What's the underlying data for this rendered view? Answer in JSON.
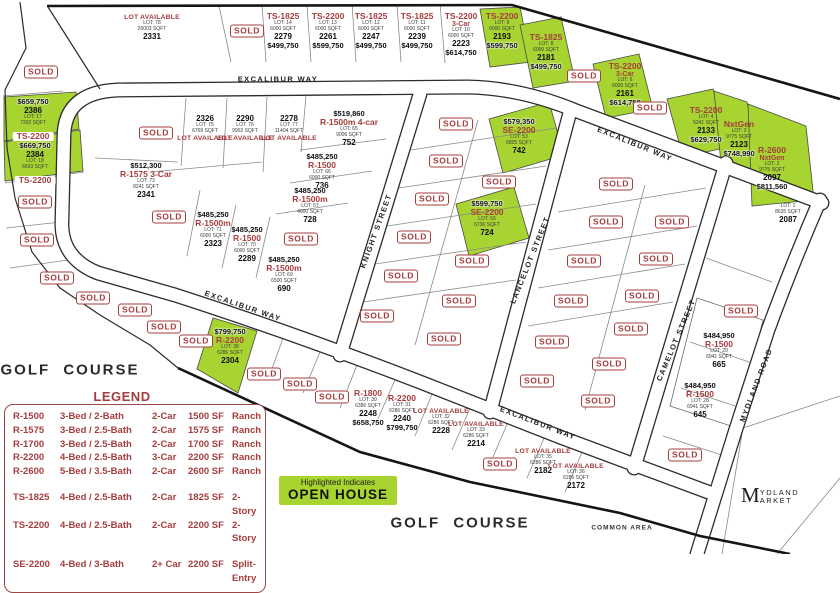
{
  "colors": {
    "accent_red": "#a63d3d",
    "highlight_green": "#a7d430",
    "gold": "#a8863c"
  },
  "header": {
    "development_line1": "HIDDEN BRIDGE",
    "development_line2": "RANCH",
    "builder": "EXCALIBUR",
    "builder_sub": "HOMES",
    "phone": "752-1259",
    "sales_address": "2097 Excalibur Way"
  },
  "sold": {
    "label": "SOLD"
  },
  "open_house": {
    "line1": "Highlighted Indicates",
    "line2": "OPEN HOUSE"
  },
  "market": {
    "initial": "M",
    "line1": "YDLAND",
    "line2": "ARKET"
  },
  "legend": {
    "title": "LEGEND",
    "rows": [
      {
        "model": "R-1500",
        "beds": "3-Bed / 2-Bath",
        "car": "2-Car",
        "sqft": "1500 SF",
        "style": "Ranch"
      },
      {
        "model": "R-1575",
        "beds": "3-Bed / 2.5-Bath",
        "car": "2-Car",
        "sqft": "1575 SF",
        "style": "Ranch"
      },
      {
        "model": "R-1700",
        "beds": "3-Bed / 2.5-Bath",
        "car": "2-Car",
        "sqft": "1700 SF",
        "style": "Ranch"
      },
      {
        "model": "R-2200",
        "beds": "4-Bed / 2.5-Bath",
        "car": "3-Car",
        "sqft": "2200 SF",
        "style": "Ranch"
      },
      {
        "model": "R-2600",
        "beds": "5-Bed / 3.5-Bath",
        "car": "2-Car",
        "sqft": "2600 SF",
        "style": "Ranch"
      },
      {
        "model": "TS-1825",
        "beds": "4-Bed / 2.5-Bath",
        "car": "2-Car",
        "sqft": "1825 SF",
        "style": "2-Story",
        "cls": "gap"
      },
      {
        "model": "TS-2200",
        "beds": "4-Bed / 2.5-Bath",
        "car": "2-Car",
        "sqft": "2200 SF",
        "style": "2-Story"
      },
      {
        "model": "SE-2200",
        "beds": "4-Bed / 3-Bath",
        "car": "2+ Car",
        "sqft": "2200 SF",
        "style": "Split-Entry",
        "cls": "gap"
      }
    ]
  },
  "streets": [
    {
      "text": "EXCALIBUR WAY",
      "x": 278,
      "y": 79,
      "rot": 0
    },
    {
      "text": "EXCALIBUR WAY",
      "x": 635,
      "y": 144,
      "rot": 22
    },
    {
      "text": "EXCALIBUR WAY",
      "x": 243,
      "y": 306,
      "rot": 19
    },
    {
      "text": "EXCALIBUR WAY",
      "x": 538,
      "y": 423,
      "rot": 21
    },
    {
      "text": "KNIGHT STREET",
      "x": 376,
      "y": 231,
      "rot": -70
    },
    {
      "text": "LANCELOT STREET",
      "x": 530,
      "y": 260,
      "rot": -68
    },
    {
      "text": "CAMELOT STREET",
      "x": 676,
      "y": 340,
      "rot": -67
    },
    {
      "text": "MYDLAND ROAD",
      "x": 756,
      "y": 385,
      "rot": -69
    }
  ],
  "area_labels": [
    {
      "text": "GOLF COURSE",
      "x": 70,
      "y": 370,
      "cls": "golf"
    },
    {
      "text": "GOLF COURSE",
      "x": 460,
      "y": 523,
      "cls": "golf"
    },
    {
      "text": "COMMON AREA",
      "x": 622,
      "y": 528,
      "cls": "tiny-label"
    }
  ],
  "sold_badges": [
    {
      "x": 247,
      "y": 31
    },
    {
      "x": 41,
      "y": 72
    },
    {
      "x": 584,
      "y": 76
    },
    {
      "x": 650,
      "y": 108
    },
    {
      "x": 35,
      "y": 202
    },
    {
      "x": 37,
      "y": 240
    },
    {
      "x": 57,
      "y": 278
    },
    {
      "x": 93,
      "y": 298
    },
    {
      "x": 156,
      "y": 133
    },
    {
      "x": 169,
      "y": 217
    },
    {
      "x": 301,
      "y": 239
    },
    {
      "x": 135,
      "y": 310
    },
    {
      "x": 164,
      "y": 327
    },
    {
      "x": 196,
      "y": 341
    },
    {
      "x": 264,
      "y": 374
    },
    {
      "x": 300,
      "y": 384
    },
    {
      "x": 332,
      "y": 397
    },
    {
      "x": 456,
      "y": 124
    },
    {
      "x": 446,
      "y": 161
    },
    {
      "x": 432,
      "y": 199
    },
    {
      "x": 414,
      "y": 237
    },
    {
      "x": 401,
      "y": 276
    },
    {
      "x": 377,
      "y": 316
    },
    {
      "x": 499,
      "y": 182
    },
    {
      "x": 472,
      "y": 261
    },
    {
      "x": 459,
      "y": 301
    },
    {
      "x": 444,
      "y": 339
    },
    {
      "x": 616,
      "y": 184
    },
    {
      "x": 606,
      "y": 222
    },
    {
      "x": 672,
      "y": 222
    },
    {
      "x": 584,
      "y": 261
    },
    {
      "x": 656,
      "y": 259
    },
    {
      "x": 571,
      "y": 301
    },
    {
      "x": 642,
      "y": 296
    },
    {
      "x": 631,
      "y": 329
    },
    {
      "x": 552,
      "y": 342
    },
    {
      "x": 609,
      "y": 364
    },
    {
      "x": 537,
      "y": 381
    },
    {
      "x": 598,
      "y": 401
    },
    {
      "x": 500,
      "y": 464
    },
    {
      "x": 741,
      "y": 311
    },
    {
      "x": 685,
      "y": 455
    }
  ],
  "lots": [
    {
      "x": 152,
      "y": 14,
      "lines": [
        {
          "k": "avail",
          "t": "LOT AVAILABLE"
        },
        {
          "k": "tiny",
          "t": "LOT: 78"
        },
        {
          "k": "tiny",
          "t": "26003 SQFT"
        },
        {
          "k": "addr",
          "t": "2331"
        }
      ]
    },
    {
      "x": 283,
      "y": 12,
      "lines": [
        {
          "k": "model",
          "t": "TS-1825"
        },
        {
          "k": "tiny",
          "t": "LOT: 14"
        },
        {
          "k": "tiny",
          "t": "6000 SQFT"
        },
        {
          "k": "addr",
          "t": "2279"
        },
        {
          "k": "price",
          "t": "$499,750"
        }
      ]
    },
    {
      "x": 328,
      "y": 12,
      "lines": [
        {
          "k": "model",
          "t": "TS-2200"
        },
        {
          "k": "tiny",
          "t": "LOT: 13"
        },
        {
          "k": "tiny",
          "t": "6000 SQFT"
        },
        {
          "k": "addr",
          "t": "2261"
        },
        {
          "k": "price",
          "t": "$599,750"
        }
      ]
    },
    {
      "x": 371,
      "y": 12,
      "lines": [
        {
          "k": "model",
          "t": "TS-1825"
        },
        {
          "k": "tiny",
          "t": "LOT: 12"
        },
        {
          "k": "tiny",
          "t": "6000 SQFT"
        },
        {
          "k": "addr",
          "t": "2247"
        },
        {
          "k": "price",
          "t": "$499,750"
        }
      ]
    },
    {
      "x": 417,
      "y": 12,
      "lines": [
        {
          "k": "model",
          "t": "TS-1825"
        },
        {
          "k": "tiny",
          "t": "LOT: 11"
        },
        {
          "k": "tiny",
          "t": "6000 SQFT"
        },
        {
          "k": "addr",
          "t": "2239"
        },
        {
          "k": "price",
          "t": "$499,750"
        }
      ]
    },
    {
      "x": 461,
      "y": 12,
      "lines": [
        {
          "k": "model",
          "t": "TS-2200"
        },
        {
          "k": "modelx",
          "t": "3-Car"
        },
        {
          "k": "tiny",
          "t": "LOT: 10"
        },
        {
          "k": "tiny",
          "t": "6000 SQFT"
        },
        {
          "k": "addr",
          "t": "2223"
        },
        {
          "k": "price",
          "t": "$614,750"
        }
      ]
    },
    {
      "x": 502,
      "y": 12,
      "lines": [
        {
          "k": "model",
          "t": "TS-2200"
        },
        {
          "k": "tiny",
          "t": "LOT: 9"
        },
        {
          "k": "tiny",
          "t": "6000 SQFT"
        },
        {
          "k": "addr",
          "t": "2193"
        },
        {
          "k": "price",
          "t": "$599,750"
        }
      ]
    },
    {
      "x": 546,
      "y": 33,
      "lines": [
        {
          "k": "model",
          "t": "TS-1825"
        },
        {
          "k": "tiny",
          "t": "LOT: 8"
        },
        {
          "k": "tiny",
          "t": "6000 SQFT"
        },
        {
          "k": "addr",
          "t": "2181"
        },
        {
          "k": "price",
          "t": "$499,750"
        }
      ]
    },
    {
      "x": 625,
      "y": 62,
      "lines": [
        {
          "k": "model",
          "t": "TS-2200"
        },
        {
          "k": "modelx",
          "t": "3-Car"
        },
        {
          "k": "tiny",
          "t": "LOT: 6"
        },
        {
          "k": "tiny",
          "t": "6000 SQFT"
        },
        {
          "k": "addr",
          "t": "2161"
        },
        {
          "k": "price",
          "t": "$614,750"
        }
      ]
    },
    {
      "x": 706,
      "y": 106,
      "lines": [
        {
          "k": "model",
          "t": "TS-2200"
        },
        {
          "k": "tiny",
          "t": "LOT: 4"
        },
        {
          "k": "tiny",
          "t": "5241 SQFT"
        },
        {
          "k": "addr",
          "t": "2133"
        },
        {
          "k": "price",
          "t": "$629,750"
        }
      ]
    },
    {
      "x": 739,
      "y": 120,
      "lines": [
        {
          "k": "model",
          "t": "NxtGen"
        },
        {
          "k": "tiny",
          "t": "LOT: 3"
        },
        {
          "k": "tiny",
          "t": "9775 SQFT"
        },
        {
          "k": "addr",
          "t": "2123"
        },
        {
          "k": "price",
          "t": "$748,990"
        }
      ]
    },
    {
      "x": 772,
      "y": 146,
      "lines": [
        {
          "k": "model",
          "t": "R-2600"
        },
        {
          "k": "modelx",
          "t": "NxtGen"
        },
        {
          "k": "tiny",
          "t": "LOT: 2"
        },
        {
          "k": "tiny",
          "t": "9775 SQFT"
        },
        {
          "k": "addr",
          "t": "2097"
        },
        {
          "k": "price",
          "t": "$811,560"
        }
      ]
    },
    {
      "x": 788,
      "y": 204,
      "lines": [
        {
          "k": "tiny",
          "t": "LOT: 1"
        },
        {
          "k": "tiny",
          "t": "8635 SQFT"
        },
        {
          "k": "addr",
          "t": "2087"
        }
      ]
    },
    {
      "x": 33,
      "y": 98,
      "lines": [
        {
          "k": "price",
          "t": "$659,750"
        },
        {
          "k": "addr",
          "t": "2386"
        },
        {
          "k": "tiny",
          "t": "LOT: 17"
        },
        {
          "k": "tiny",
          "t": "7202 SQFT"
        },
        {
          "k": "pill",
          "t": "TS-2200"
        }
      ]
    },
    {
      "x": 35,
      "y": 142,
      "lines": [
        {
          "k": "price",
          "t": "$669,750"
        },
        {
          "k": "addr",
          "t": "2384"
        },
        {
          "k": "tiny",
          "t": "LOT: 18"
        },
        {
          "k": "tiny",
          "t": "6693 SQFT"
        },
        {
          "k": "pill",
          "t": "TS-2200"
        }
      ]
    },
    {
      "x": 205,
      "y": 114,
      "lines": [
        {
          "k": "addr",
          "t": "2326"
        },
        {
          "k": "tiny",
          "t": "LOT: 75"
        },
        {
          "k": "tiny",
          "t": "6769 SQFT"
        },
        {
          "k": "avail",
          "t": "LOT AVAILABLE"
        }
      ]
    },
    {
      "x": 245,
      "y": 114,
      "lines": [
        {
          "k": "addr",
          "t": "2290"
        },
        {
          "k": "tiny",
          "t": "LOT: 76"
        },
        {
          "k": "tiny",
          "t": "9902 SQFT"
        },
        {
          "k": "avail",
          "t": "LOT AVAILABLE"
        }
      ]
    },
    {
      "x": 289,
      "y": 114,
      "lines": [
        {
          "k": "addr",
          "t": "2278"
        },
        {
          "k": "tiny",
          "t": "LOT: 77"
        },
        {
          "k": "tiny",
          "t": "11404 SQFT"
        },
        {
          "k": "avail",
          "t": "LOT AVAILABLE"
        }
      ]
    },
    {
      "x": 146,
      "y": 162,
      "lines": [
        {
          "k": "price",
          "t": "$512,300"
        },
        {
          "k": "model",
          "t": "R-1575  3-Car"
        },
        {
          "k": "tiny",
          "t": "LOT: 73"
        },
        {
          "k": "tiny",
          "t": "8241 SQFT"
        },
        {
          "k": "addr",
          "t": "2341"
        }
      ]
    },
    {
      "x": 349,
      "y": 110,
      "lines": [
        {
          "k": "price",
          "t": "$519,860"
        },
        {
          "k": "model",
          "t": "R-1500m  4-car"
        },
        {
          "k": "tiny",
          "t": "LOT: 65"
        },
        {
          "k": "tiny",
          "t": "9006 SQFT"
        },
        {
          "k": "addr",
          "t": "752"
        }
      ]
    },
    {
      "x": 322,
      "y": 153,
      "lines": [
        {
          "k": "price",
          "t": "$485,250"
        },
        {
          "k": "model",
          "t": "R-1500"
        },
        {
          "k": "tiny",
          "t": "LOT: 66"
        },
        {
          "k": "tiny",
          "t": "6000 SQFT"
        },
        {
          "k": "addr",
          "t": "736"
        }
      ]
    },
    {
      "x": 310,
      "y": 187,
      "lines": [
        {
          "k": "price",
          "t": "$485,250"
        },
        {
          "k": "model",
          "t": "R-1500m"
        },
        {
          "k": "tiny",
          "t": "LOT: 67"
        },
        {
          "k": "tiny",
          "t": "4000 SQFT"
        },
        {
          "k": "addr",
          "t": "728"
        }
      ]
    },
    {
      "x": 213,
      "y": 211,
      "lines": [
        {
          "k": "price",
          "t": "$485,250"
        },
        {
          "k": "model",
          "t": "R-1500m"
        },
        {
          "k": "tiny",
          "t": "LOT: 71"
        },
        {
          "k": "tiny",
          "t": "6000 SQFT"
        },
        {
          "k": "addr",
          "t": "2323"
        }
      ]
    },
    {
      "x": 247,
      "y": 226,
      "lines": [
        {
          "k": "price",
          "t": "$485,250"
        },
        {
          "k": "model",
          "t": "R-1500"
        },
        {
          "k": "tiny",
          "t": "LOT: 70"
        },
        {
          "k": "tiny",
          "t": "6000 SQFT"
        },
        {
          "k": "addr",
          "t": "2289"
        }
      ]
    },
    {
      "x": 284,
      "y": 256,
      "lines": [
        {
          "k": "price",
          "t": "$485,250"
        },
        {
          "k": "model",
          "t": "R-1500m"
        },
        {
          "k": "tiny",
          "t": "LOT: 69"
        },
        {
          "k": "tiny",
          "t": "6500 SQFT"
        },
        {
          "k": "addr",
          "t": "690"
        }
      ]
    },
    {
      "x": 519,
      "y": 118,
      "lines": [
        {
          "k": "price",
          "t": "$579,350"
        },
        {
          "k": "model",
          "t": "SE-2200"
        },
        {
          "k": "tiny",
          "t": "LOT: 53"
        },
        {
          "k": "tiny",
          "t": "6805 SQFT"
        },
        {
          "k": "addr",
          "t": "742"
        }
      ]
    },
    {
      "x": 487,
      "y": 200,
      "lines": [
        {
          "k": "price",
          "t": "$599,750"
        },
        {
          "k": "model",
          "t": "SE-2200"
        },
        {
          "k": "tiny",
          "t": "LOT: 55"
        },
        {
          "k": "tiny",
          "t": "6736 SQFT"
        },
        {
          "k": "addr",
          "t": "724"
        }
      ]
    },
    {
      "x": 230,
      "y": 328,
      "lines": [
        {
          "k": "price",
          "t": "$799,750"
        },
        {
          "k": "model",
          "t": "R-2200"
        },
        {
          "k": "tiny",
          "t": "LOT: 38"
        },
        {
          "k": "tiny",
          "t": "6286 SQFT"
        },
        {
          "k": "addr",
          "t": "2304"
        }
      ]
    },
    {
      "x": 368,
      "y": 389,
      "lines": [
        {
          "k": "model",
          "t": "R-1800"
        },
        {
          "k": "tiny",
          "t": "LOT: 30"
        },
        {
          "k": "tiny",
          "t": "6386 SQFT"
        },
        {
          "k": "addr",
          "t": "2248"
        },
        {
          "k": "price",
          "t": "$658,750"
        }
      ]
    },
    {
      "x": 402,
      "y": 394,
      "lines": [
        {
          "k": "model",
          "t": "R-2200"
        },
        {
          "k": "tiny",
          "t": "LOT: 31"
        },
        {
          "k": "tiny",
          "t": "6286 SQFT"
        },
        {
          "k": "addr",
          "t": "2240"
        },
        {
          "k": "price",
          "t": "$799,750"
        }
      ]
    },
    {
      "x": 441,
      "y": 408,
      "lines": [
        {
          "k": "avail",
          "t": "LOT AVAILABLE"
        },
        {
          "k": "tiny",
          "t": "LOT: 32"
        },
        {
          "k": "tiny",
          "t": "6286 SQFT"
        },
        {
          "k": "addr",
          "t": "2228"
        }
      ]
    },
    {
      "x": 476,
      "y": 421,
      "lines": [
        {
          "k": "avail",
          "t": "LOT AVAILABLE"
        },
        {
          "k": "tiny",
          "t": "LOT: 33"
        },
        {
          "k": "tiny",
          "t": "6286 SQFT"
        },
        {
          "k": "addr",
          "t": "2214"
        }
      ]
    },
    {
      "x": 543,
      "y": 448,
      "lines": [
        {
          "k": "avail",
          "t": "LOT AVAILABLE"
        },
        {
          "k": "tiny",
          "t": "LOT: 35"
        },
        {
          "k": "tiny",
          "t": "6286 SQFT"
        },
        {
          "k": "addr",
          "t": "2182"
        }
      ]
    },
    {
      "x": 576,
      "y": 463,
      "lines": [
        {
          "k": "avail",
          "t": "LOT AVAILABLE"
        },
        {
          "k": "tiny",
          "t": "LOT: 36"
        },
        {
          "k": "tiny",
          "t": "6286 SQFT"
        },
        {
          "k": "addr",
          "t": "2172"
        }
      ]
    },
    {
      "x": 719,
      "y": 332,
      "lines": [
        {
          "k": "price",
          "t": "$484,950"
        },
        {
          "k": "model",
          "t": "R-1500"
        },
        {
          "k": "tiny",
          "t": "LOT: 29"
        },
        {
          "k": "tiny",
          "t": "6941 SQFT"
        },
        {
          "k": "addr",
          "t": "665"
        }
      ]
    },
    {
      "x": 700,
      "y": 382,
      "lines": [
        {
          "k": "price",
          "t": "$484,950"
        },
        {
          "k": "model",
          "t": "R-1500"
        },
        {
          "k": "tiny",
          "t": "LOT: 28"
        },
        {
          "k": "tiny",
          "t": "6941 SQFT"
        },
        {
          "k": "addr",
          "t": "645"
        }
      ]
    }
  ]
}
